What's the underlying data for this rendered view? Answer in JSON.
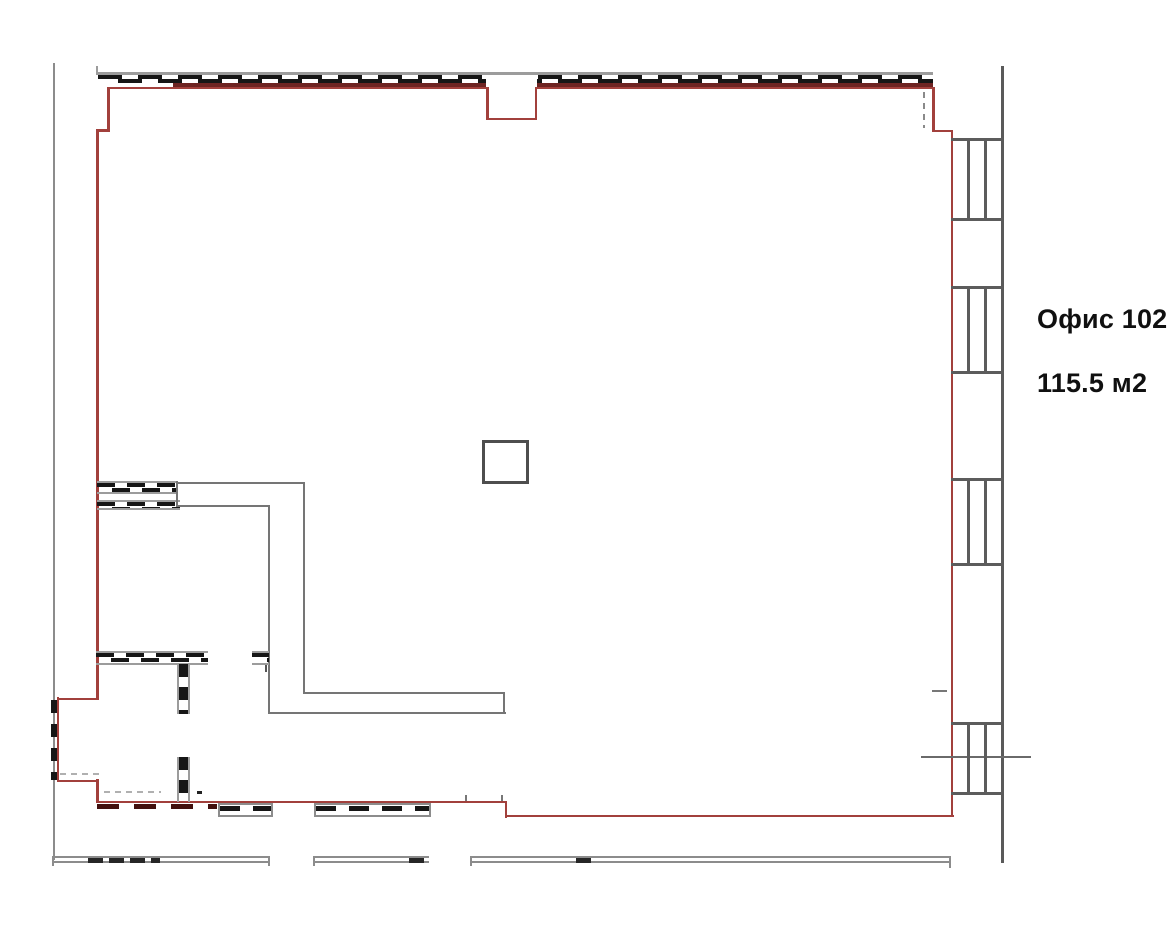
{
  "labels": {
    "room_name": "Офис 102",
    "room_area": "115.5 м2"
  },
  "colors": {
    "outline_red": "#a2403c",
    "dark_red": "#6e2422",
    "wall_gray": "#757575",
    "rail_gray": "#9c9c9c",
    "boundary_gray": "#8c8c8c",
    "window_gray": "#5c5c5c",
    "hatch_black": "#161616",
    "text_black": "#101010",
    "bg": "#ffffff"
  }
}
